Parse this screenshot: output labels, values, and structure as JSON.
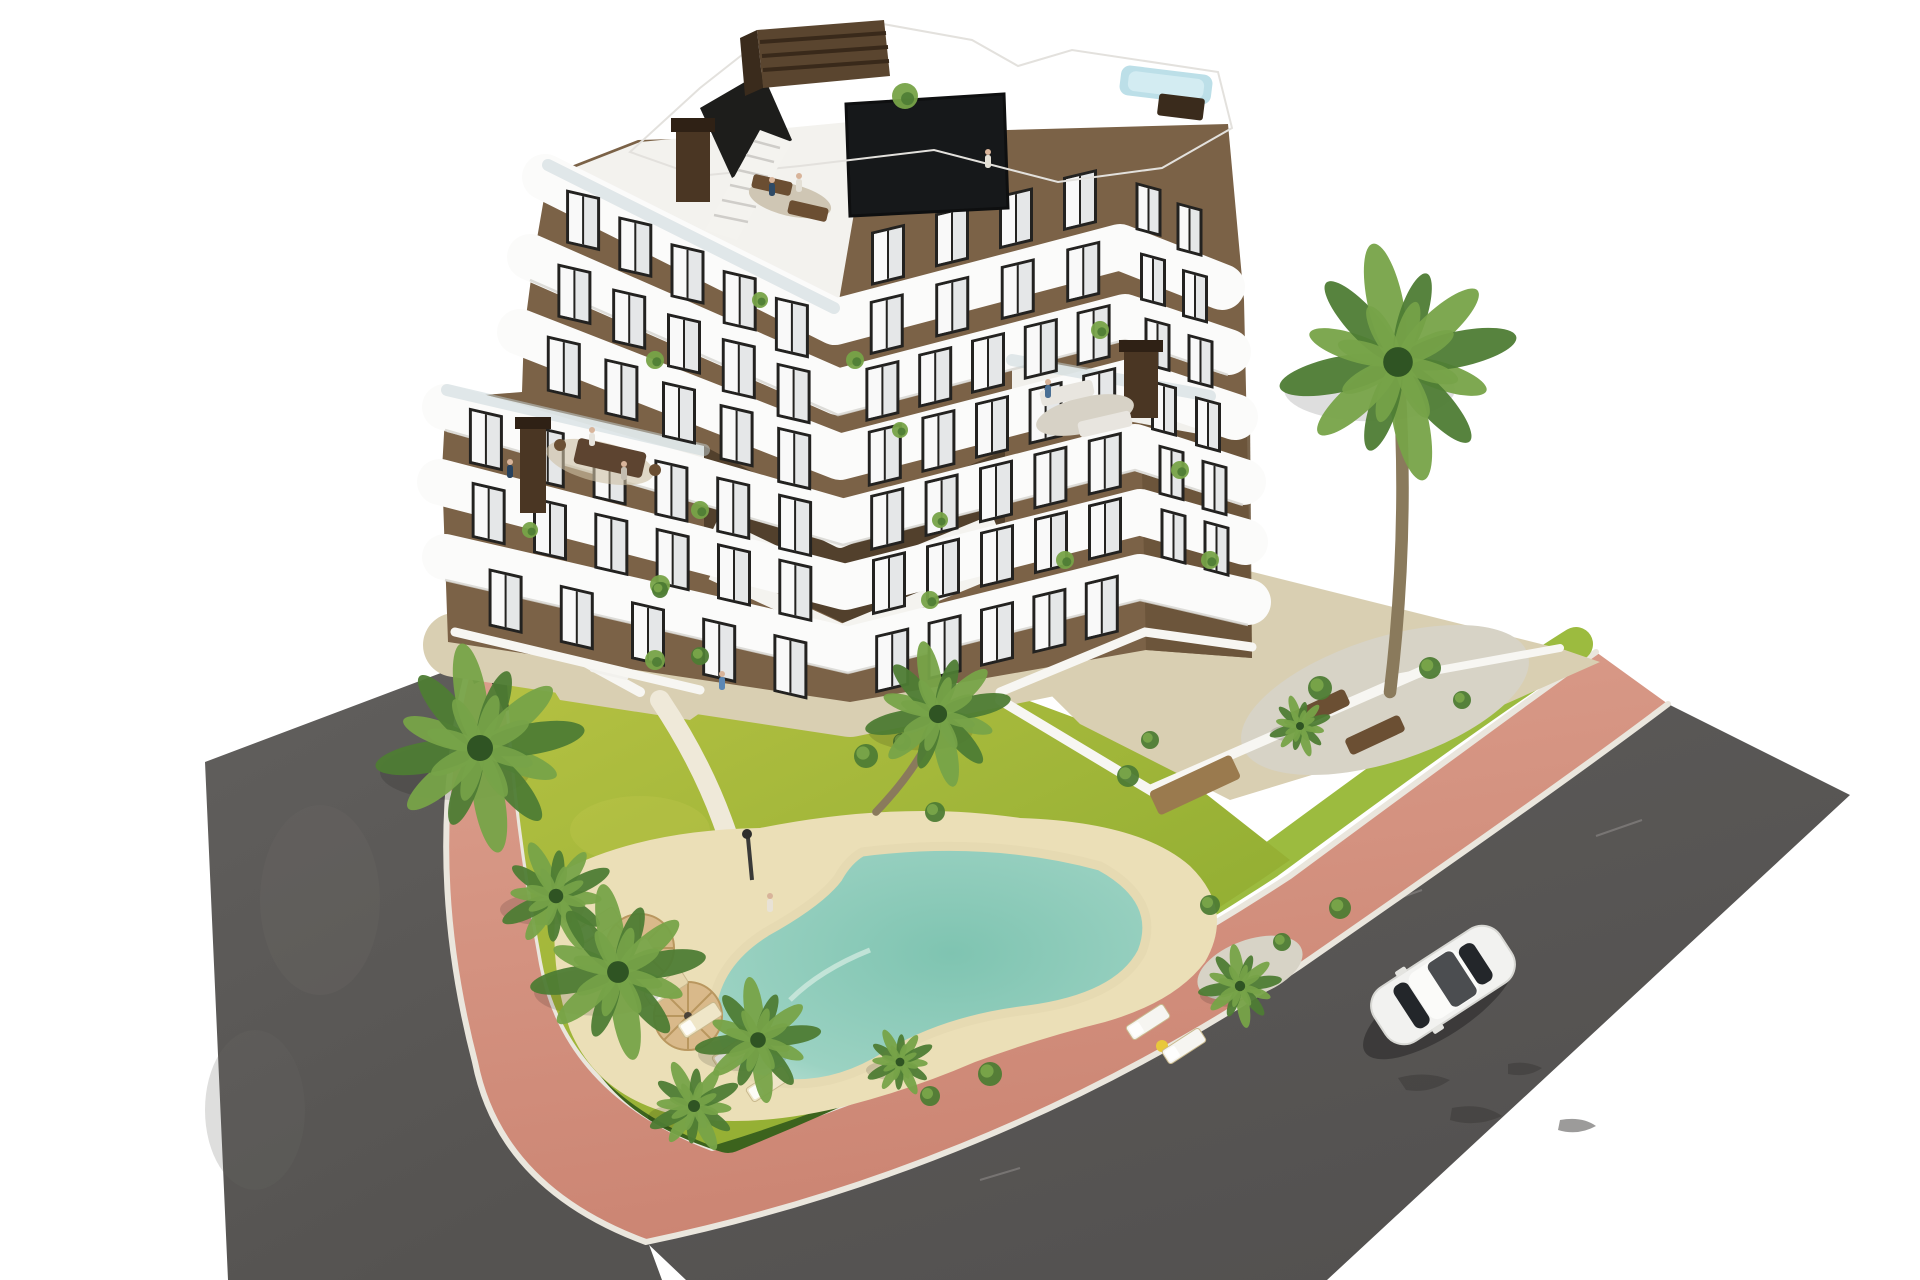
{
  "scene": {
    "type": "aerial-architectural-render",
    "description": "Aerial 3D render of a modern 7-level apartment building with brown facades and white curved balcony bands, rooftop terrace with small pool, landscaped garden with lagoon-style pool, palm trees, hedge ring, pink paved sidewalk, asphalt roads and one white car",
    "counts": {
      "building_levels": 7,
      "palm_trees": 10,
      "sun_loungers": 8,
      "parasols": 2,
      "cars": 1,
      "rooftop_pools": 1,
      "ground_pools": 1
    }
  },
  "colors": {
    "background": "#ffffff",
    "asphalt": "#5e5c5a",
    "asphalt2": "#565452",
    "sidewalk": "#d28f7f",
    "curb": "#eae6dd",
    "grass_strip": "#9cbb3f",
    "hedge": "#3c631d",
    "lawn": "#aaba3c",
    "sand": "#ebdfb7",
    "pool_rim": "#e6dab2",
    "gravel": "#d7d3c6",
    "beige": "#d9cfb2",
    "beige2": "#d5cbb0",
    "facade": "#7b6247",
    "facade_right": "#6a543a",
    "courtyard": "#52402c",
    "band_white": "#fbfbfa",
    "roof_white": "#f8f7f4",
    "window_frame": "#232220",
    "window_glass": "#e5e7e8",
    "dark_glass": "#16181a",
    "rooftop_pool": "#bcdfe8",
    "umbrella": "#d9b98a",
    "wood": "#9a7a4e",
    "car_body": "#f2f2f0",
    "palm1": "#4e7c34",
    "palm2": "#77a348",
    "palm_center": "#2f5423",
    "trunk": "#8a7a5c",
    "chimney": "#4a3623"
  },
  "render": {
    "window_rows": [
      [
        470,
        618,
        826,
        700,
        5,
        34,
        58,
        13
      ],
      [
        866,
        700,
        1128,
        634,
        5,
        34,
        58,
        -13.5
      ],
      [
        458,
        530,
        826,
        622,
        6,
        34,
        56,
        13
      ],
      [
        862,
        622,
        1132,
        554,
        5,
        34,
        56,
        -13.5
      ],
      [
        1152,
        552,
        1238,
        576,
        2,
        26,
        50,
        15
      ],
      [
        455,
        455,
        826,
        558,
        6,
        34,
        56,
        13
      ],
      [
        860,
        558,
        1132,
        489,
        5,
        34,
        56,
        -13.5
      ],
      [
        1150,
        487,
        1236,
        517,
        2,
        26,
        50,
        15
      ],
      [
        535,
        380,
        823,
        494,
        5,
        34,
        56,
        13
      ],
      [
        858,
        494,
        1126,
        424,
        5,
        34,
        56,
        -13.5
      ],
      [
        1142,
        422,
        1230,
        454,
        2,
        26,
        50,
        15
      ],
      [
        547,
        305,
        821,
        429,
        5,
        34,
        54,
        13
      ],
      [
        856,
        429,
        1120,
        359,
        5,
        34,
        54,
        -13.5
      ],
      [
        1136,
        357,
        1222,
        390,
        2,
        26,
        48,
        15
      ],
      [
        557,
        230,
        818,
        364,
        5,
        34,
        54,
        13
      ],
      [
        854,
        364,
        1116,
        294,
        4,
        34,
        54,
        -13.5
      ],
      [
        1132,
        292,
        1216,
        325,
        2,
        26,
        48,
        15
      ],
      [
        856,
        295,
        1112,
        222,
        4,
        34,
        54,
        -13.5
      ],
      [
        1128,
        220,
        1210,
        260,
        2,
        26,
        48,
        15
      ]
    ],
    "palms": [
      {
        "x": 480,
        "y": 748,
        "r": 100
      },
      {
        "x": 556,
        "y": 896,
        "r": 56
      },
      {
        "x": 618,
        "y": 972,
        "r": 84
      },
      {
        "x": 758,
        "y": 1040,
        "r": 60
      },
      {
        "x": 694,
        "y": 1106,
        "r": 46
      },
      {
        "x": 900,
        "y": 1062,
        "r": 34
      },
      {
        "x": 938,
        "y": 714,
        "r": 70,
        "trunk": [
          876,
          812
        ]
      },
      {
        "x": 1240,
        "y": 986,
        "r": 40
      },
      {
        "x": 1300,
        "y": 726,
        "r": 30
      },
      {
        "x": 1398,
        "y": 362,
        "r": 114,
        "trunk": [
          1390,
          692
        ]
      }
    ],
    "loungers": [
      {
        "x": 598,
        "y": 925,
        "a": -33,
        "c": "#e6d7ae"
      },
      {
        "x": 632,
        "y": 956,
        "a": -33,
        "c": "#efe6c8"
      },
      {
        "x": 666,
        "y": 988,
        "a": -33,
        "c": "#e6d7ae"
      },
      {
        "x": 700,
        "y": 1020,
        "a": -33,
        "c": "#efe6c8"
      },
      {
        "x": 734,
        "y": 1052,
        "a": -33,
        "c": "#e6d7ae"
      },
      {
        "x": 768,
        "y": 1084,
        "a": -33,
        "c": "#efe6c8"
      },
      {
        "x": 1148,
        "y": 1022,
        "a": -33,
        "c": "#f6f5f1"
      },
      {
        "x": 1184,
        "y": 1046,
        "a": -33,
        "c": "#f6f5f1"
      }
    ],
    "shrubs": [
      {
        "x": 866,
        "y": 756,
        "r": 12
      },
      {
        "x": 902,
        "y": 742,
        "r": 9
      },
      {
        "x": 1128,
        "y": 776,
        "r": 11
      },
      {
        "x": 1150,
        "y": 740,
        "r": 9
      },
      {
        "x": 1320,
        "y": 688,
        "r": 12
      },
      {
        "x": 1430,
        "y": 668,
        "r": 11
      },
      {
        "x": 1462,
        "y": 700,
        "r": 9
      },
      {
        "x": 1210,
        "y": 905,
        "r": 10
      },
      {
        "x": 1282,
        "y": 942,
        "r": 9
      },
      {
        "x": 935,
        "y": 812,
        "r": 10
      },
      {
        "x": 700,
        "y": 656,
        "r": 9
      },
      {
        "x": 660,
        "y": 590,
        "r": 8
      },
      {
        "x": 1340,
        "y": 908,
        "r": 11
      },
      {
        "x": 990,
        "y": 1074,
        "r": 12
      },
      {
        "x": 930,
        "y": 1096,
        "r": 10
      }
    ],
    "balcony_plants": [
      {
        "x": 660,
        "y": 585,
        "r": 10
      },
      {
        "x": 700,
        "y": 510,
        "r": 9
      },
      {
        "x": 655,
        "y": 660,
        "r": 10
      },
      {
        "x": 930,
        "y": 600,
        "r": 9
      },
      {
        "x": 1065,
        "y": 560,
        "r": 9
      },
      {
        "x": 940,
        "y": 520,
        "r": 8
      },
      {
        "x": 855,
        "y": 360,
        "r": 9
      },
      {
        "x": 900,
        "y": 430,
        "r": 8
      },
      {
        "x": 1100,
        "y": 330,
        "r": 9
      },
      {
        "x": 655,
        "y": 360,
        "r": 9
      },
      {
        "x": 760,
        "y": 300,
        "r": 8
      },
      {
        "x": 1180,
        "y": 470,
        "r": 9
      },
      {
        "x": 1210,
        "y": 560,
        "r": 9
      },
      {
        "x": 530,
        "y": 530,
        "r": 8
      },
      {
        "x": 905,
        "y": 96,
        "r": 13
      }
    ],
    "people": [
      {
        "x": 770,
        "y": 912,
        "c": "#e8e2d6"
      },
      {
        "x": 510,
        "y": 478,
        "c": "#27425e"
      },
      {
        "x": 592,
        "y": 446,
        "c": "#e6e3dc"
      },
      {
        "x": 624,
        "y": 480,
        "c": "#c4bdb0"
      },
      {
        "x": 722,
        "y": 690,
        "c": "#5b87b4"
      },
      {
        "x": 772,
        "y": 196,
        "c": "#2e4a66"
      },
      {
        "x": 799,
        "y": 192,
        "c": "#e4e0d6"
      },
      {
        "x": 988,
        "y": 168,
        "c": "#e4e0d6"
      },
      {
        "x": 1048,
        "y": 398,
        "c": "#4a6f94"
      }
    ]
  }
}
